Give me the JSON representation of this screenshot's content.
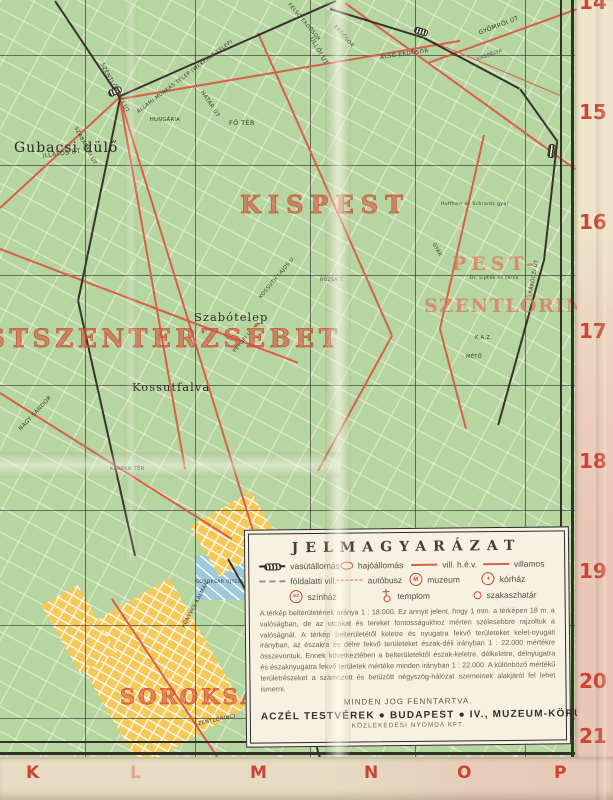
{
  "colors": {
    "paper": "#e8ddc5",
    "map_background": "#f3ead3",
    "kispest_yellow": "#f4c957",
    "erzsebet_blue": "#8bc5dc",
    "szentlorinc_blue": "#82c3db",
    "fields_green": "#b9d7a3",
    "wekerle_green": "#a6cf93",
    "north_pink": "#f0bcba",
    "road_red": "#d8604a",
    "railway_black": "#3a332c",
    "district_label_red": "#d5503a",
    "margin_index_red": "#cc4434"
  },
  "map": {
    "district_labels": [
      {
        "t": "KISPEST",
        "x": 240,
        "y": 190,
        "s": 24,
        "ls": 7
      },
      {
        "t": "PESTSZENTERZSÉBET",
        "x": -60,
        "y": 324,
        "s": 25,
        "ls": 4.5
      },
      {
        "t": "PEST-",
        "x": 452,
        "y": 253,
        "s": 19,
        "ls": 5,
        "c": "rgba(224,117,92,0.75)"
      },
      {
        "t": "SZENTLŐRINC",
        "x": 424,
        "y": 295,
        "s": 19,
        "ls": 1.5,
        "c": "rgba(224,117,92,0.75)"
      },
      {
        "t": "SOROKSÁR",
        "x": 120,
        "y": 684,
        "s": 21,
        "ls": 3
      }
    ],
    "place_labels": [
      {
        "t": "Gubacsi dülő",
        "x": 14,
        "y": 140,
        "s": 14
      },
      {
        "t": "Szabótelep",
        "x": 194,
        "y": 310,
        "s": 11.5
      },
      {
        "t": "Kossutfalva",
        "x": 132,
        "y": 380,
        "s": 11.5
      }
    ],
    "street_labels": [
      {
        "t": "ILLATOS ÚT",
        "x": 42,
        "y": 153,
        "r": -8,
        "s": 6
      },
      {
        "t": "SZENTLŐRINCI ÚT",
        "x": 104,
        "y": 62,
        "r": 62,
        "s": 5.5
      },
      {
        "t": "ÁLLAMI MUNKÁS TELEP (WEKERLE TELEP)",
        "x": 136,
        "y": 110,
        "r": -37,
        "s": 5
      },
      {
        "t": "HATÁR ÚT",
        "x": 204,
        "y": 90,
        "r": 57,
        "s": 5.5
      },
      {
        "t": "ÜLLŐI ÚT",
        "x": 314,
        "y": 36,
        "r": 60,
        "s": 6
      },
      {
        "t": "FELSŐ ERDŐSOR",
        "x": 291,
        "y": 2,
        "r": 50,
        "s": 5
      },
      {
        "t": "ERDŐSOR",
        "x": 337,
        "y": 24,
        "r": 50,
        "s": 5
      },
      {
        "t": "ALSÓ ERDŐSOR",
        "x": 380,
        "y": 55,
        "r": -8,
        "s": 5.5
      },
      {
        "t": "GYÖMRŐI ÚT",
        "x": 478,
        "y": 30,
        "r": -21,
        "s": 6
      },
      {
        "t": "VASPÁLYA",
        "x": 476,
        "y": 57,
        "r": -20,
        "s": 5,
        "c": "#55504a"
      },
      {
        "t": "HUNGÁRIA",
        "x": 150,
        "y": 117,
        "s": 5
      },
      {
        "t": "FŐ TÉR",
        "x": 229,
        "y": 119,
        "s": 6.5
      },
      {
        "t": "SZABADKAI ÚT",
        "x": 78,
        "y": 126,
        "r": 62,
        "s": 5
      },
      {
        "t": "NAGY SÁNDOR",
        "x": 18,
        "y": 428,
        "r": -47,
        "s": 5.5
      },
      {
        "t": "KLAPKA TÉR",
        "x": 110,
        "y": 466,
        "s": 5
      },
      {
        "t": "KOSSUTH LAJOS U.",
        "x": 258,
        "y": 296,
        "r": -50,
        "s": 5
      },
      {
        "t": "PETŐFI U.",
        "x": 232,
        "y": 350,
        "r": -50,
        "s": 5
      },
      {
        "t": "RÓZSA T.",
        "x": 320,
        "y": 278,
        "s": 4.5
      },
      {
        "t": "GYÁR",
        "x": 436,
        "y": 242,
        "r": 62,
        "s": 5
      },
      {
        "t": "Hoffherr és Schrantz gyár",
        "x": 441,
        "y": 202,
        "s": 4.5
      },
      {
        "t": "Dr. Lipták és társa",
        "x": 470,
        "y": 276,
        "s": 4.5
      },
      {
        "t": "K.A.Z.",
        "x": 475,
        "y": 335,
        "s": 5
      },
      {
        "t": "MÉTŐ",
        "x": 466,
        "y": 354,
        "s": 5
      },
      {
        "t": "RÁKÓCZI ÚT",
        "x": 528,
        "y": 293,
        "r": -80,
        "s": 5
      },
      {
        "t": "KÖNYVES KÁLMÁN",
        "x": 181,
        "y": 626,
        "r": -62,
        "s": 5
      },
      {
        "t": "SOROKSÁR ÚJTELEP",
        "x": 196,
        "y": 580,
        "s": 4.5
      },
      {
        "t": "SZENTLŐRINCI",
        "x": 194,
        "y": 722,
        "r": -12,
        "s": 5
      }
    ]
  },
  "margins": {
    "right_numbers": [
      {
        "t": "14",
        "x": 4,
        "y": -10
      },
      {
        "t": "15",
        "x": 4,
        "y": 100
      },
      {
        "t": "16",
        "x": 4,
        "y": 210
      },
      {
        "t": "17",
        "x": 4,
        "y": 319
      },
      {
        "t": "18",
        "x": 4,
        "y": 449
      },
      {
        "t": "19",
        "x": 4,
        "y": 559
      },
      {
        "t": "20",
        "x": 4,
        "y": 669
      },
      {
        "t": "21",
        "x": 4,
        "y": 724
      }
    ],
    "bottom_letters": [
      {
        "t": "K",
        "x": 26,
        "y": 6
      },
      {
        "t": "L",
        "x": 130,
        "y": 6,
        "o": 0.35
      },
      {
        "t": "M",
        "x": 250,
        "y": 6
      },
      {
        "t": "N",
        "x": 364,
        "y": 6
      },
      {
        "t": "O",
        "x": 457,
        "y": 6
      },
      {
        "t": "P",
        "x": 554,
        "y": 6
      }
    ]
  },
  "legend": {
    "title": "JELMAGYARÁZAT",
    "rows": [
      [
        {
          "icon": "railway-station",
          "label": "vasútállomás"
        },
        {
          "icon": "boat-station",
          "label": "hajóállomás"
        },
        {
          "icon": "hev-line",
          "label": "vill. h.é.v."
        },
        {
          "icon": "tram-line",
          "label": "villamos"
        }
      ],
      [
        {
          "icon": "underground-line",
          "label": "földalatti vill."
        },
        {
          "icon": "bus-line",
          "label": "autóbusz"
        },
        {
          "icon": "museum",
          "label": "muzeum",
          "glyph": "M"
        },
        {
          "icon": "hospital",
          "label": "kórház",
          "glyph": "+"
        }
      ],
      [
        {
          "icon": "theater",
          "label": "színház",
          "glyph": "SZ"
        },
        {
          "icon": "church",
          "label": "templom"
        },
        {
          "icon": "section-boundary",
          "label": "szakaszhatár"
        }
      ]
    ],
    "body": "A térkép belterületének aránya 1 : 18.000. Ez annyit jelent, hogy 1 mm. a térképen 18 m. a valóságban, de az utcákat és tereket fontosságukhoz mérten szélesebbre rajzoltuk a valóságnál. A térkép belterületétől keletre és nyugatra fekvő területeket kelet-nyugati irányban, az északra és délre fekvő területeket észak-déli irányban 1 : 22.000 mértékre összevontuk. Ennek következtében a belterületektől észak-keletre, délkeletre, délnyugatra és északnyugatra fekvő területek mértéke minden irányban 1 : 22.000. A különböző mértékű területrészeket a számozott és betűzött négyszög-hálózat szemeinek alakjáról fel lehet ismerni.",
    "rights": "MINDEN JOG FENNTARTVA.",
    "publisher": "ACZÉL TESTVÉREK ● BUDAPEST ● IV., MUZEUM-KÖRUT 9",
    "printer": "KÖZLEKEDESI NYOMDA KFT."
  }
}
